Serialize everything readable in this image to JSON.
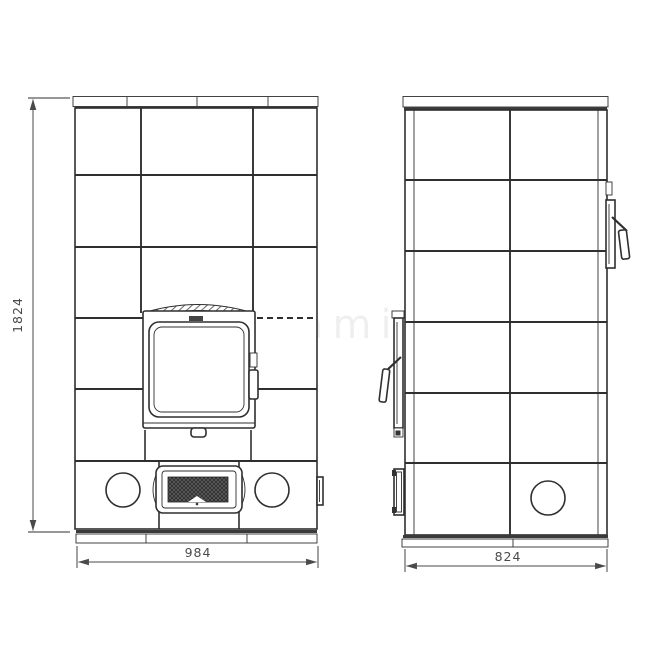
{
  "dimensions": {
    "height": "1824",
    "front_width": "984",
    "side_width": "824"
  },
  "watermark": {
    "text": "Kaminofen"
  },
  "colors": {
    "background": "#ffffff",
    "line": "#2f2f2f",
    "dimension_text": "#4a4a4a",
    "grille_fill": "#2f2f2f"
  }
}
